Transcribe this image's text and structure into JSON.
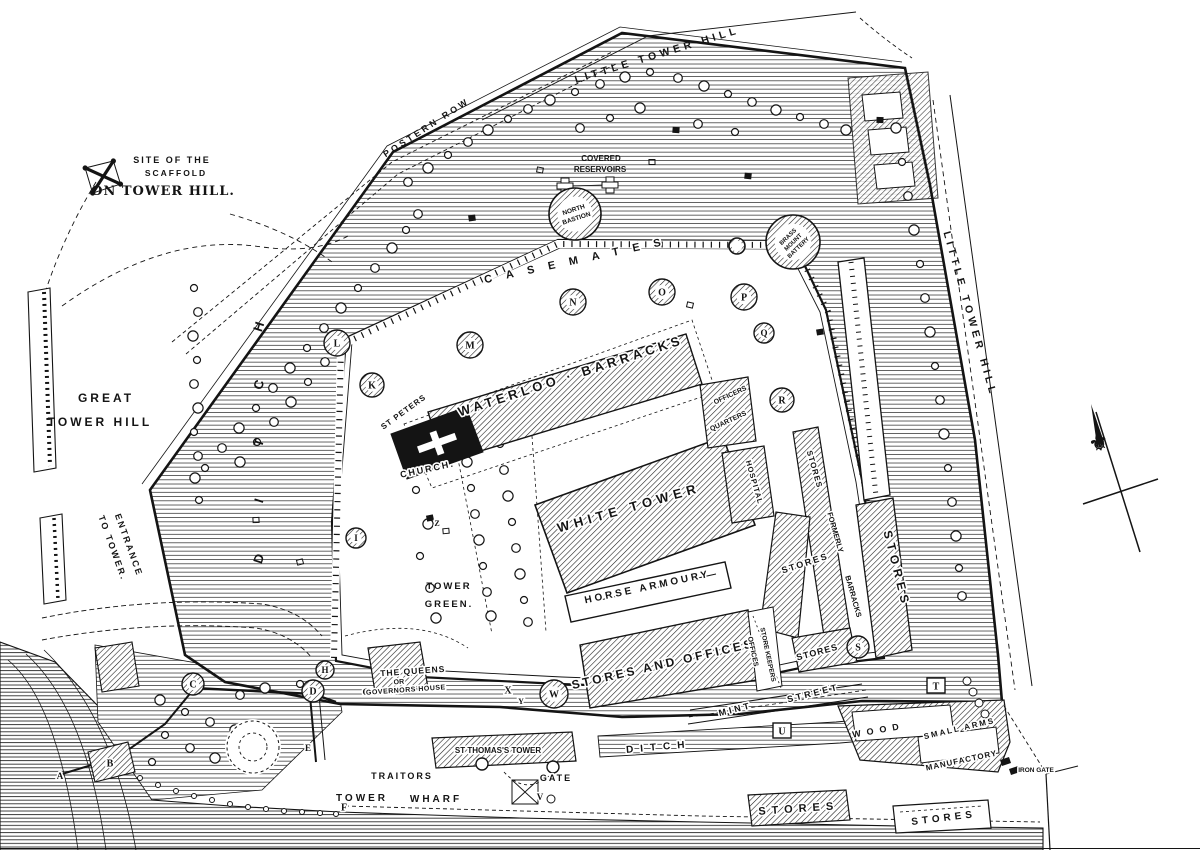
{
  "map_title": "Plan of the Tower of London",
  "colors": {
    "ink": "#141414",
    "paper": "#ffffff",
    "texture": "#3a3a3a"
  },
  "compass": {
    "name": "north-arrow",
    "glyph": "⚜"
  },
  "labels": [
    {
      "t": "SITE OF THE",
      "x": 172,
      "y": 163,
      "fs": 9,
      "ls": 2
    },
    {
      "t": "SCAFFOLD",
      "x": 176,
      "y": 176,
      "fs": 8.5,
      "ls": 2
    },
    {
      "t": "ON TOWER HILL.",
      "x": 163,
      "y": 195,
      "fs": 13,
      "ls": 1,
      "serif": true
    },
    {
      "t": "LITTLE TOWER HILL",
      "x": 658,
      "y": 58,
      "rot": -17,
      "fs": 10.5,
      "ls": 4
    },
    {
      "t": "POSTERN ROW",
      "x": 428,
      "y": 130,
      "rot": -33,
      "fs": 9,
      "ls": 3
    },
    {
      "t": "COVERED",
      "x": 601,
      "y": 161,
      "fs": 8
    },
    {
      "t": "RESERVOIRS",
      "x": 600,
      "y": 172,
      "fs": 8
    },
    {
      "t": "CASEMATES",
      "x": 580,
      "y": 263,
      "rot": -12,
      "fs": 11,
      "ls": 14,
      "halo": true
    },
    {
      "t": "LITTLE TOWER HILL",
      "x": 967,
      "y": 315,
      "rot": 74,
      "fs": 10.5,
      "ls": 4
    },
    {
      "t": "GREAT",
      "x": 106,
      "y": 402,
      "fs": 12,
      "ls": 3
    },
    {
      "t": "TOWER HILL",
      "x": 100,
      "y": 426,
      "fs": 12,
      "ls": 3
    },
    {
      "t": "ENTRANCE",
      "x": 126,
      "y": 546,
      "rot": 70,
      "fs": 9,
      "ls": 2
    },
    {
      "t": "TO TOWER.",
      "x": 110,
      "y": 549,
      "rot": 70,
      "fs": 9,
      "ls": 2
    },
    {
      "t": "DITCH",
      "x": 263,
      "y": 560,
      "dy": -58,
      "rot": -72,
      "fs": 13,
      "vert": true
    },
    {
      "t": "WATERLOO · BARRACKS",
      "x": 572,
      "y": 380,
      "rot": -18,
      "fs": 13,
      "ls": 4,
      "halo": true
    },
    {
      "t": "ST PETERS",
      "x": 405,
      "y": 414,
      "rot": -36,
      "fs": 8,
      "ls": 1,
      "halo": true
    },
    {
      "t": "CHURCH.",
      "x": 428,
      "y": 472,
      "rot": -12,
      "fs": 9,
      "ls": 2,
      "halo": true
    },
    {
      "t": "WHITE TOWER",
      "x": 630,
      "y": 512,
      "rot": -16,
      "fs": 13,
      "ls": 5,
      "halo": true
    },
    {
      "t": "HORSE ARMOURY",
      "x": 648,
      "y": 590,
      "rot": -12,
      "fs": 10,
      "ls": 3,
      "halo": true
    },
    {
      "t": "TOWER",
      "x": 449,
      "y": 589,
      "fs": 9.5,
      "ls": 2
    },
    {
      "t": "GREEN.",
      "x": 449,
      "y": 607,
      "fs": 9.5,
      "ls": 2
    },
    {
      "t": "THE QUEENS",
      "x": 413,
      "y": 674,
      "rot": -4,
      "fs": 8.5,
      "ls": 1,
      "halo": true
    },
    {
      "t": "OR",
      "x": 399,
      "y": 684,
      "rot": -4,
      "fs": 7,
      "halo": true
    },
    {
      "t": "GOVERNORS HOUSE",
      "x": 406,
      "y": 692,
      "rot": -4,
      "fs": 7,
      "ls": 0.5,
      "halo": true
    },
    {
      "t": "OFFICERS",
      "x": 731,
      "y": 397,
      "rot": -25,
      "fs": 7,
      "halo": true
    },
    {
      "t": "QUARTERS",
      "x": 729,
      "y": 423,
      "rot": -25,
      "fs": 7,
      "halo": true
    },
    {
      "t": "HOSPITAL",
      "x": 752,
      "y": 483,
      "rot": 74,
      "fs": 7.5,
      "ls": 1,
      "halo": true
    },
    {
      "t": "STORES",
      "x": 812,
      "y": 470,
      "rot": 74,
      "fs": 8,
      "ls": 1,
      "halo": true
    },
    {
      "t": "STORES",
      "x": 806,
      "y": 566,
      "rot": -18,
      "fs": 9,
      "ls": 2,
      "halo": true
    },
    {
      "t": "FORMERLY",
      "x": 833,
      "y": 533,
      "rot": 74,
      "fs": 7.5,
      "halo": true
    },
    {
      "t": "BARRACKS",
      "x": 851,
      "y": 597,
      "rot": 74,
      "fs": 7.5,
      "halo": true
    },
    {
      "t": "STORES",
      "x": 893,
      "y": 570,
      "rot": 76,
      "fs": 12,
      "ls": 5,
      "halo": true
    },
    {
      "t": "STORES AND OFFICES",
      "x": 664,
      "y": 668,
      "rot": -13,
      "fs": 12,
      "ls": 3,
      "halo": true
    },
    {
      "t": "OFFICES",
      "x": 751,
      "y": 652,
      "rot": 78,
      "fs": 7,
      "halo": true
    },
    {
      "t": "STORE KEEPERS",
      "x": 766,
      "y": 655,
      "rot": 78,
      "fs": 6.5,
      "halo": true
    },
    {
      "t": "STORES",
      "x": 818,
      "y": 655,
      "rot": -15,
      "fs": 9,
      "ls": 1,
      "halo": true
    },
    {
      "t": "MINT",
      "x": 736,
      "y": 712,
      "rot": -14,
      "fs": 9,
      "ls": 3,
      "halo": true
    },
    {
      "t": "STREET",
      "x": 814,
      "y": 696,
      "rot": -14,
      "fs": 9,
      "ls": 3,
      "halo": true
    },
    {
      "t": "DITCH",
      "x": 659,
      "y": 750,
      "rot": -5,
      "fs": 10,
      "ls": 7,
      "halo": true
    },
    {
      "t": "WOOD",
      "x": 879,
      "y": 733,
      "rot": -10,
      "fs": 9,
      "ls": 6,
      "halo": true
    },
    {
      "t": "SMALL ARMS",
      "x": 960,
      "y": 731,
      "rot": -13,
      "fs": 8,
      "ls": 2,
      "halo": true
    },
    {
      "t": "MANUFACTORY",
      "x": 962,
      "y": 763,
      "rot": -12,
      "fs": 8,
      "ls": 1,
      "halo": true
    },
    {
      "t": "IRON GATE",
      "x": 1036,
      "y": 772,
      "fs": 6.5,
      "halo": true
    },
    {
      "t": "STORES",
      "x": 799,
      "y": 812,
      "rot": -4,
      "fs": 11,
      "ls": 6,
      "halo": true
    },
    {
      "t": "STORES",
      "x": 944,
      "y": 821,
      "rot": -7,
      "fs": 10,
      "ls": 4,
      "halo": true
    },
    {
      "t": "ST THOMAS'S TOWER",
      "x": 498,
      "y": 753,
      "fs": 8,
      "halo": true
    },
    {
      "t": "TRAITORS",
      "x": 402,
      "y": 779,
      "fs": 9,
      "ls": 2,
      "halo": true
    },
    {
      "t": "GATE",
      "x": 556,
      "y": 781,
      "fs": 9,
      "ls": 2,
      "halo": true
    },
    {
      "t": "TOWER",
      "x": 362,
      "y": 801,
      "fs": 10,
      "ls": 3
    },
    {
      "t": "WHARF",
      "x": 436,
      "y": 802,
      "fs": 10,
      "ls": 3
    }
  ],
  "markers": [
    {
      "ch": "A",
      "x": 60,
      "y": 776,
      "fs": 9
    },
    {
      "ch": "B",
      "x": 110,
      "y": 763,
      "fs": 10
    },
    {
      "ch": "C",
      "x": 193,
      "y": 684,
      "fs": 10,
      "shape": "circle",
      "r": 11
    },
    {
      "ch": "D",
      "x": 313,
      "y": 691,
      "fs": 10,
      "shape": "circle",
      "r": 11
    },
    {
      "ch": "E",
      "x": 308,
      "y": 748,
      "fs": 9
    },
    {
      "ch": "F",
      "x": 344,
      "y": 807,
      "fs": 10
    },
    {
      "ch": "G",
      "x": 366,
      "y": 692,
      "fs": 9
    },
    {
      "ch": "H",
      "x": 325,
      "y": 670,
      "fs": 9,
      "shape": "circle",
      "r": 9
    },
    {
      "ch": "I",
      "x": 356,
      "y": 538,
      "fs": 9,
      "shape": "circle",
      "r": 10
    },
    {
      "ch": "K",
      "x": 372,
      "y": 385,
      "fs": 10,
      "shape": "circle",
      "r": 12
    },
    {
      "ch": "L",
      "x": 337,
      "y": 343,
      "fs": 10,
      "shape": "circle",
      "r": 13
    },
    {
      "ch": "M",
      "x": 470,
      "y": 345,
      "fs": 10,
      "shape": "circle",
      "r": 13
    },
    {
      "ch": "N",
      "x": 573,
      "y": 302,
      "fs": 10,
      "shape": "circle",
      "r": 13
    },
    {
      "ch": "O",
      "x": 662,
      "y": 292,
      "fs": 10,
      "shape": "circle",
      "r": 13
    },
    {
      "ch": "P",
      "x": 744,
      "y": 297,
      "fs": 10,
      "shape": "circle",
      "r": 13
    },
    {
      "ch": "Q",
      "x": 764,
      "y": 333,
      "fs": 9,
      "shape": "circle",
      "r": 10
    },
    {
      "ch": "R",
      "x": 782,
      "y": 400,
      "fs": 10,
      "shape": "circle",
      "r": 12
    },
    {
      "ch": "S",
      "x": 858,
      "y": 647,
      "fs": 10,
      "shape": "circle",
      "r": 11
    },
    {
      "ch": "T",
      "x": 936,
      "y": 686,
      "fs": 10,
      "shape": "square"
    },
    {
      "ch": "U",
      "x": 782,
      "y": 731,
      "fs": 10,
      "shape": "square"
    },
    {
      "ch": "V",
      "x": 540,
      "y": 797,
      "fs": 9
    },
    {
      "ch": "W",
      "x": 554,
      "y": 694,
      "fs": 10,
      "shape": "circle",
      "r": 14
    },
    {
      "ch": "X",
      "x": 508,
      "y": 690,
      "fs": 10
    },
    {
      "ch": "Y",
      "x": 521,
      "y": 701,
      "fs": 8
    },
    {
      "ch": "Z",
      "x": 437,
      "y": 523,
      "fs": 8
    }
  ],
  "bastions": [
    {
      "name": "north-bastion",
      "cx": 575,
      "cy": 214,
      "r": 26,
      "rot": -18,
      "fs": 6.5,
      "dy": 9,
      "lines": [
        "NORTH",
        "BASTION"
      ]
    },
    {
      "name": "brass-mount-battery",
      "cx": 793,
      "cy": 242,
      "r": 27,
      "rot": -44,
      "fs": 6,
      "dy": 7.5,
      "lines": [
        "BRASS",
        "MOUNT",
        "BATTERY"
      ]
    },
    {
      "name": "casemate-turret",
      "cx": 737,
      "cy": 246,
      "r": 8,
      "lines": []
    }
  ]
}
